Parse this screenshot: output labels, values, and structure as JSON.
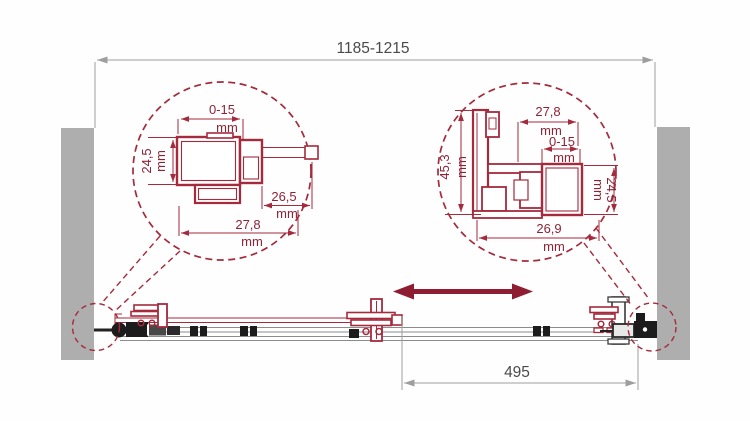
{
  "colors": {
    "maroon": "#A42A3C",
    "maroon_text": "#8E2337",
    "arrow": "#8E1D32",
    "wall": "#AEAEAE",
    "dim_gray": "#9E9E9E",
    "dim_text": "#4A4A4A",
    "black": "#1C1C1C"
  },
  "dimensions": {
    "overall_width": "1185-1215",
    "door_travel": "495"
  },
  "left_detail": {
    "top_value": "0-15",
    "top_unit": "mm",
    "side_value": "24,5",
    "side_unit": "mm",
    "inner_value": "26,5",
    "inner_unit": "mm",
    "bottom_value": "27,8",
    "bottom_unit": "mm"
  },
  "right_detail": {
    "top_value": "27,8",
    "top_unit": "mm",
    "adjust_value": "0-15",
    "adjust_unit": "mm",
    "side_value": "45,3",
    "side_unit": "mm",
    "right_value": "24,5",
    "right_unit": "mm",
    "bottom_value": "26,9",
    "bottom_unit": "mm"
  }
}
